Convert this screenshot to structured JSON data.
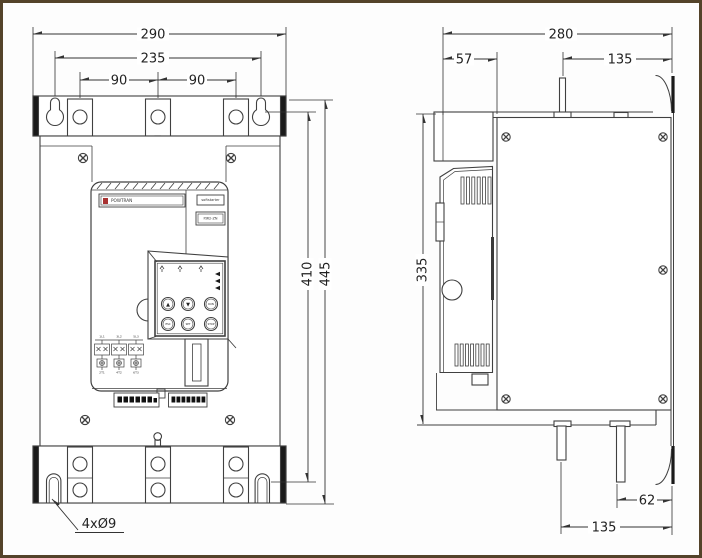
{
  "dimensions": {
    "front": {
      "overall_width": "290",
      "mount_slot_spacing": "235",
      "terminal_spacing_left": "90",
      "terminal_spacing_right": "90",
      "mount_hole_height": "410",
      "overall_height": "445",
      "mount_hole_note": "4xØ9"
    },
    "side": {
      "overall_depth": "280",
      "front_section_depth": "57",
      "top_busbar_offset": "135",
      "body_height": "335",
      "bottom_busbar_spacing": "62",
      "bottom_busbar_offset": "135"
    }
  },
  "front_panel": {
    "brand": "POWTRAN",
    "product": "softstarter",
    "model": "PJR2-ZN",
    "keypad": {
      "button_labels": [
        "▲",
        "▼",
        "RUN",
        "ESC",
        "SET",
        "STOP"
      ]
    },
    "wiring": {
      "input_labels": [
        "1L1",
        "3L2",
        "5L3"
      ],
      "output_labels": [
        "2T1",
        "4T2",
        "6T3"
      ]
    }
  }
}
